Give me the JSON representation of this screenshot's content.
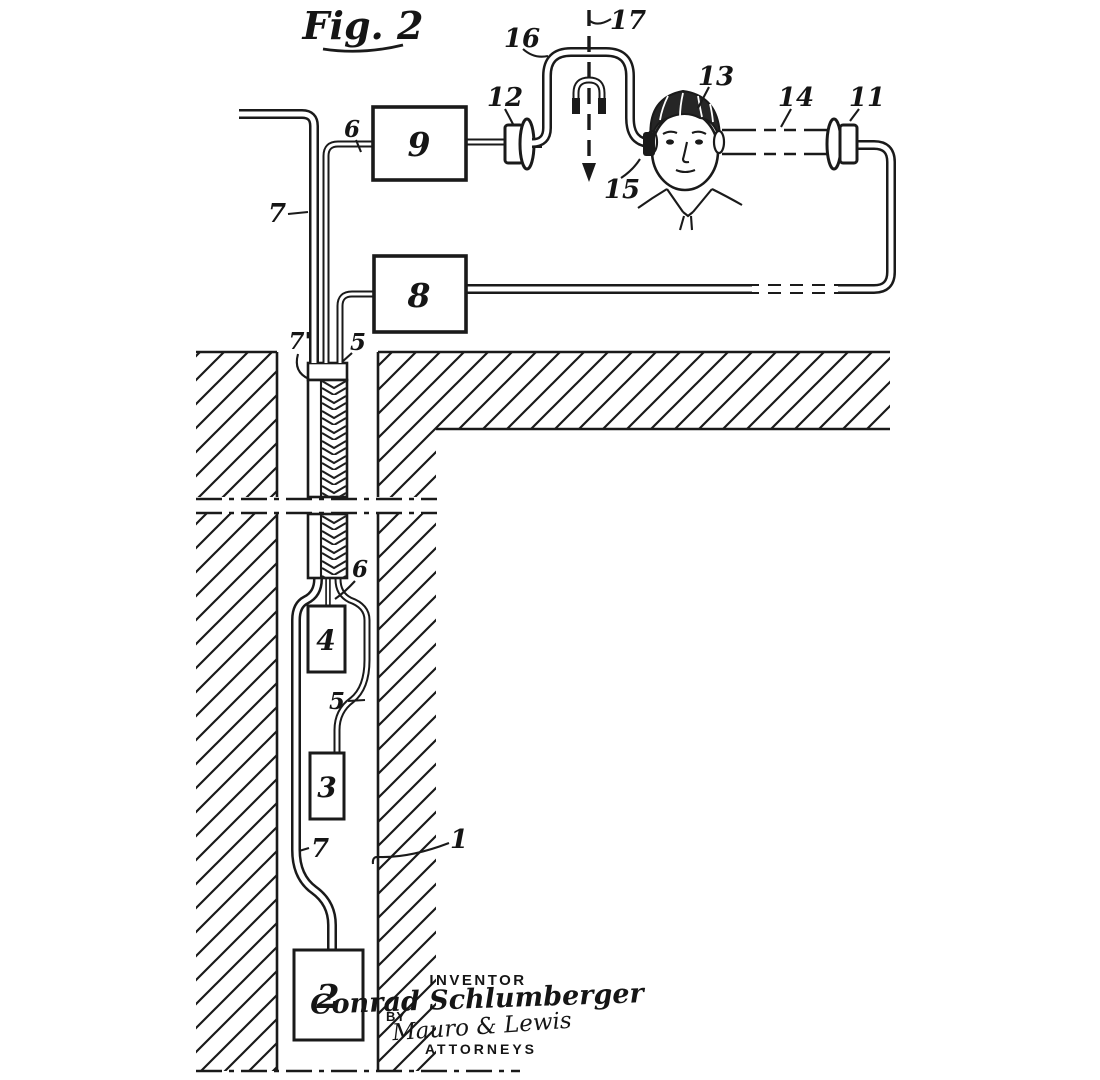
{
  "figure_title": "Fig. 2",
  "ref_labels": {
    "n1": "1",
    "n2": "2",
    "n3": "3",
    "n4": "4",
    "n5": "5",
    "n6": "6",
    "n7": "7",
    "n7p": "7'",
    "n8": "8",
    "n9": "9",
    "n11": "11",
    "n12": "12",
    "n13": "13",
    "n14": "14",
    "n15": "15",
    "n16": "16",
    "n17": "17"
  },
  "signature_block": {
    "inventor_caption": "INVENTOR",
    "inventor_name": "Conrad Schlumberger",
    "by_label": "BY",
    "attorney_names": "Mauro & Lewis",
    "attorneys_caption": "ATTORNEYS"
  },
  "colors": {
    "ink": "#1a1a1a",
    "paper": "#ffffff"
  }
}
